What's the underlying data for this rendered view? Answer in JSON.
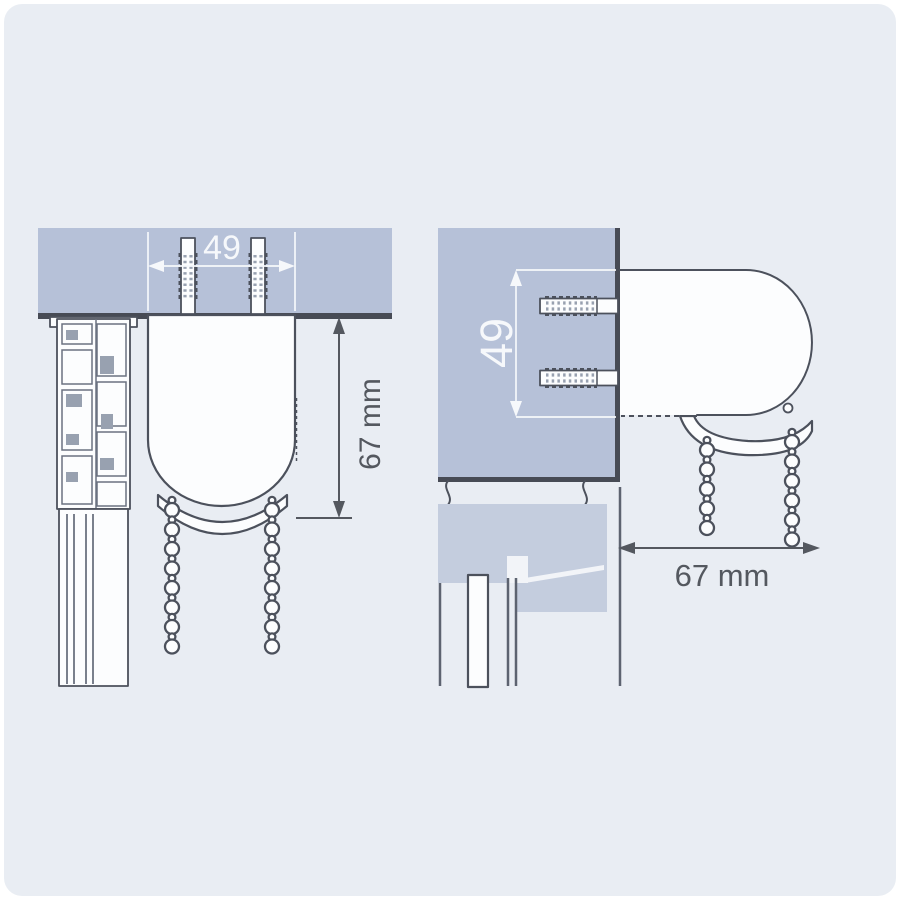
{
  "colors": {
    "page_margin": "#ffffff",
    "background": "#e9edf3",
    "block": "#b6c1d8",
    "block_light": "#c4cdde",
    "outline": "#4c515c",
    "edge": "#474b55",
    "rib": "#98a1b0",
    "white_fill": "#fcfdfe",
    "frame_line": "#5d6370",
    "glass_line": "#6b7280",
    "notch": "#f2f4f8",
    "dim_dark": "#54585f",
    "dim_light": "#f6f8fb"
  },
  "ceiling_mount_view": {
    "screw_spacing_dim": "49",
    "depth_dim": "67 mm"
  },
  "wall_mount_view": {
    "screw_spacing_dim": "49",
    "depth_dim": "67 mm"
  }
}
